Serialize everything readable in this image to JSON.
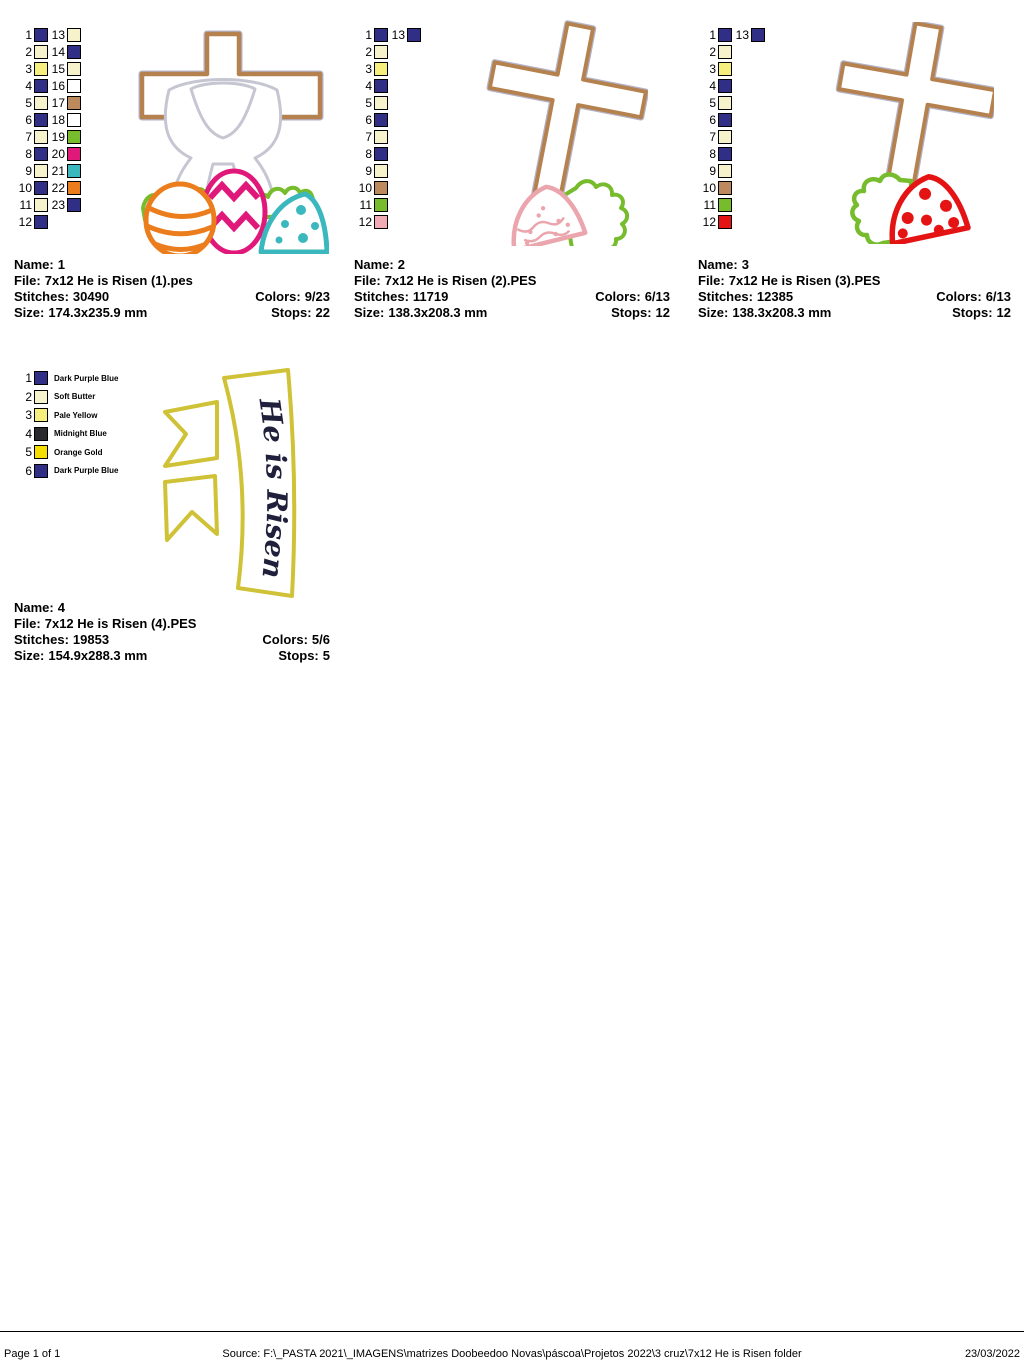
{
  "labels": {
    "name": "Name:",
    "file": "File:",
    "stitches": "Stitches:",
    "colors": "Colors:",
    "size": "Size:",
    "stops": "Stops:"
  },
  "designs": [
    {
      "name": "1",
      "file": "7x12 He is Risen (1).pes",
      "stitches": "30490",
      "colors": "9/23",
      "size": "174.3x235.9 mm",
      "stops": "22",
      "palette": [
        {
          "n": 1,
          "color": "#312e85"
        },
        {
          "n": 2,
          "color": "#f6f2cb"
        },
        {
          "n": 3,
          "color": "#f6ef7d"
        },
        {
          "n": 4,
          "color": "#312e85"
        },
        {
          "n": 5,
          "color": "#f6f2cb"
        },
        {
          "n": 6,
          "color": "#312e85"
        },
        {
          "n": 7,
          "color": "#f6f2cb"
        },
        {
          "n": 8,
          "color": "#312e85"
        },
        {
          "n": 9,
          "color": "#f6f2cb"
        },
        {
          "n": 10,
          "color": "#312e85"
        },
        {
          "n": 11,
          "color": "#f6f2cb"
        },
        {
          "n": 12,
          "color": "#312e85"
        },
        {
          "n": 13,
          "color": "#f6f2cb"
        },
        {
          "n": 14,
          "color": "#312e85"
        },
        {
          "n": 15,
          "color": "#f6f2cb"
        },
        {
          "n": 16,
          "color": "#ffffff"
        },
        {
          "n": 17,
          "color": "#bd8a5e"
        },
        {
          "n": 18,
          "color": "#ffffff"
        },
        {
          "n": 19,
          "color": "#76bc2d"
        },
        {
          "n": 20,
          "color": "#e0187a"
        },
        {
          "n": 21,
          "color": "#3ab8bd"
        },
        {
          "n": 22,
          "color": "#ec7d1c"
        },
        {
          "n": 23,
          "color": "#312e85"
        }
      ]
    },
    {
      "name": "2",
      "file": "7x12 He is Risen (2).PES",
      "stitches": "11719",
      "colors": "6/13",
      "size": "138.3x208.3 mm",
      "stops": "12",
      "palette": [
        {
          "n": 1,
          "color": "#312e85"
        },
        {
          "n": 2,
          "color": "#f6f2cb"
        },
        {
          "n": 3,
          "color": "#f6ef7d"
        },
        {
          "n": 4,
          "color": "#312e85"
        },
        {
          "n": 5,
          "color": "#f6f2cb"
        },
        {
          "n": 6,
          "color": "#312e85"
        },
        {
          "n": 7,
          "color": "#f6f2cb"
        },
        {
          "n": 8,
          "color": "#312e85"
        },
        {
          "n": 9,
          "color": "#f6f2cb"
        },
        {
          "n": 10,
          "color": "#bd8a5e"
        },
        {
          "n": 11,
          "color": "#76bc2d"
        },
        {
          "n": 12,
          "color": "#f2aab4"
        },
        {
          "n": 13,
          "color": "#312e85"
        }
      ]
    },
    {
      "name": "3",
      "file": "7x12 He is Risen (3).PES",
      "stitches": "12385",
      "colors": "6/13",
      "size": "138.3x208.3 mm",
      "stops": "12",
      "palette": [
        {
          "n": 1,
          "color": "#312e85"
        },
        {
          "n": 2,
          "color": "#f6f2cb"
        },
        {
          "n": 3,
          "color": "#f6ef7d"
        },
        {
          "n": 4,
          "color": "#312e85"
        },
        {
          "n": 5,
          "color": "#f6f2cb"
        },
        {
          "n": 6,
          "color": "#312e85"
        },
        {
          "n": 7,
          "color": "#f6f2cb"
        },
        {
          "n": 8,
          "color": "#312e85"
        },
        {
          "n": 9,
          "color": "#f6f2cb"
        },
        {
          "n": 10,
          "color": "#bd8a5e"
        },
        {
          "n": 11,
          "color": "#76bc2d"
        },
        {
          "n": 12,
          "color": "#e41414"
        },
        {
          "n": 13,
          "color": "#312e85"
        }
      ]
    },
    {
      "name": "4",
      "file": "7x12 He is Risen (4).PES",
      "stitches": "19853",
      "colors": "5/6",
      "size": "154.9x288.3 mm",
      "stops": "5",
      "palette": [
        {
          "n": 1,
          "color": "#312e85",
          "label": "Dark Purple Blue"
        },
        {
          "n": 2,
          "color": "#f6f2cb",
          "label": "Soft Butter"
        },
        {
          "n": 3,
          "color": "#f6ef7d",
          "label": "Pale Yellow"
        },
        {
          "n": 4,
          "color": "#29292e",
          "label": "Midnight Blue"
        },
        {
          "n": 5,
          "color": "#f6df00",
          "label": "Orange Gold"
        },
        {
          "n": 6,
          "color": "#312e85",
          "label": "Dark Purple Blue"
        }
      ]
    }
  ],
  "banner_text": "He is Risen",
  "art_colors": {
    "cross_outline": "#b5824f",
    "cross_edge": "#6a6a94",
    "robe_outline": "#c6c6d2",
    "grass": "#76bc2d",
    "egg_orange": "#ec7d1c",
    "egg_magenta": "#e0187a",
    "egg_teal": "#3ab8bd",
    "egg_pink": "#eba6ad",
    "egg_red": "#e41414",
    "banner_gold": "#cfc236",
    "banner_text_color": "#20203c"
  },
  "footer": {
    "page": "Page 1 of 1",
    "source": "Source: F:\\_PASTA 2021\\_IMAGENS\\matrizes Doobeedoo Novas\\páscoa\\Projetos 2022\\3 cruz\\7x12 He is Risen folder",
    "date": "23/03/2022"
  }
}
